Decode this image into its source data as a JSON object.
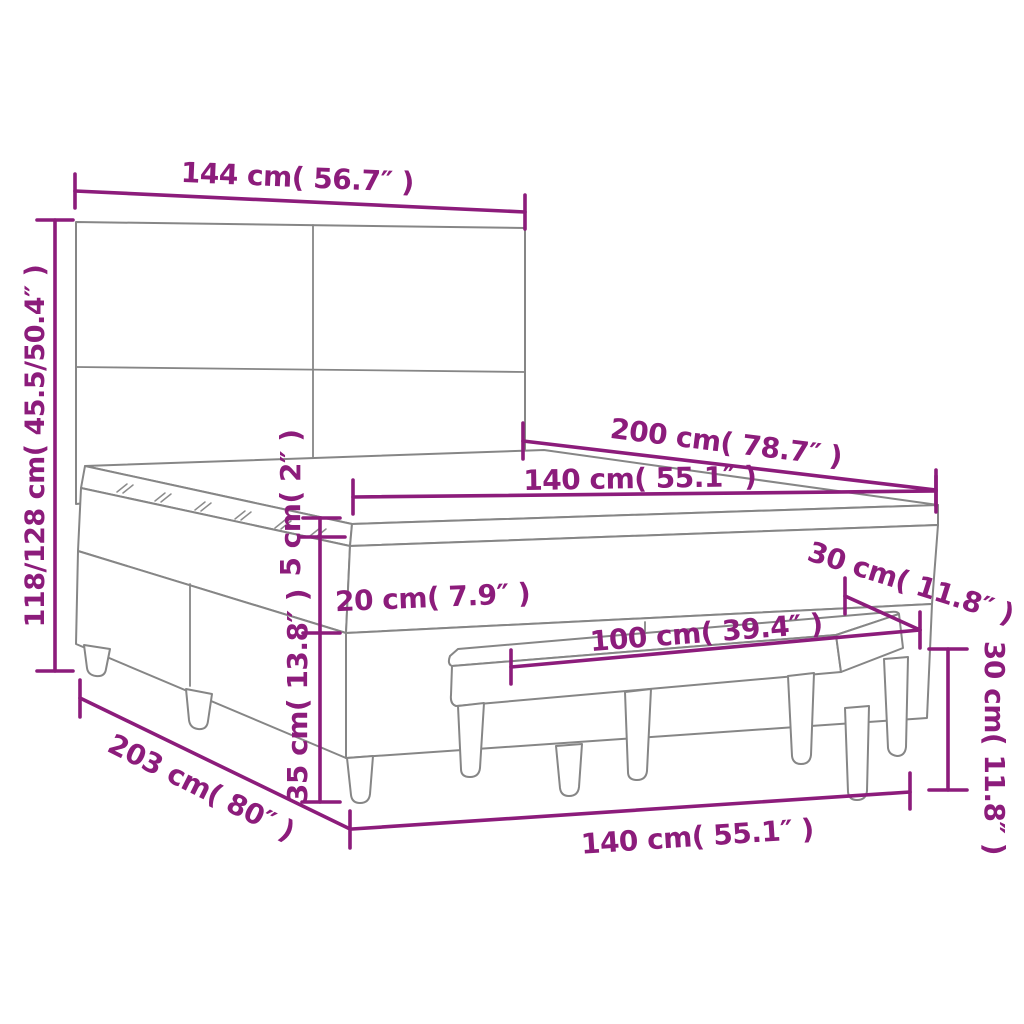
{
  "page": {
    "background": "#ffffff",
    "type": "product-dimension-diagram",
    "subject": "box-spring-bed-with-headboard-and-bench"
  },
  "colors": {
    "dimension_accent": "#8C1C7B",
    "drawing_outline": "#868686"
  },
  "measurements": {
    "headboard_width": "144 cm( 56.7″ )",
    "bed_height": "118/128 cm( 45.5/50.4″ )",
    "bed_length": "200 cm( 78.7″ )",
    "mattress_width_top": "140 cm( 55.1″ )",
    "topper_thickness": "5 cm( 2″ )",
    "mattress_thickness": "20 cm( 7.9″ )",
    "base_height": "35 cm( 13.8″ )",
    "total_length_floor": "203 cm( 80″ )",
    "bench_length": "100 cm( 39.4″ )",
    "bench_depth": "30 cm( 11.8″ )",
    "bench_height": "30 cm( 11.8″ )",
    "bed_width_floor": "140 cm( 55.1″ )"
  }
}
